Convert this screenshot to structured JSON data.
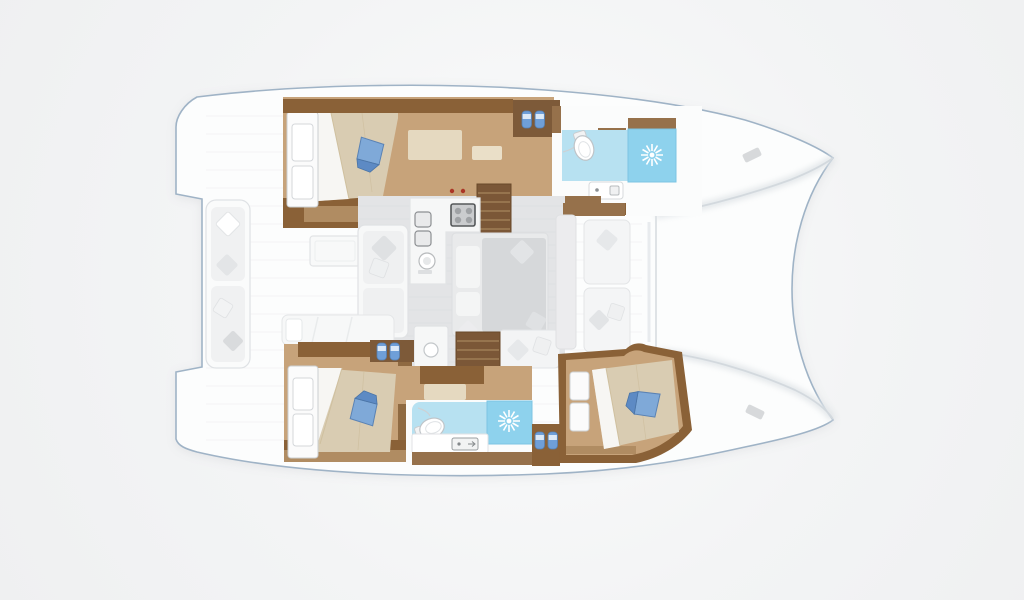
{
  "scene": {
    "subject": "catamaran-interior-floorplan",
    "view": "top-down",
    "orientation": "bow-right"
  },
  "colors": {
    "background": "#f0f1f2",
    "hull_fill": "#fcfdfd",
    "hull_outline": "#9fb3c6",
    "deck_line": "#eceef0",
    "saloon_floor": "#e3e4e6",
    "saloon_line": "#dcdee0",
    "wood_floor": "#c7a37a",
    "wood_dark": "#8a6137",
    "wood_medium": "#96714b",
    "wood_light": "#b08c62",
    "stairs": "#7b5737",
    "step_line": "#a07e57",
    "rug": "#e5d9c0",
    "rug_small": "#eadfc8",
    "mattress": "#d9ccb2",
    "mattress_fold": "#f7f6f3",
    "headboard": "#fbfbfb",
    "pillow_blue": "#7fa9d8",
    "pillow_blue_dark": "#5d8ac4",
    "slipper_blue": "#6f9fd8",
    "slipper_band": "#dce9f7",
    "bath_floor": "#b7e1f1",
    "shower_blue": "#8ed2ed",
    "sunburst": "#ffffff",
    "cushion_light": "#f0f1f2",
    "cushion_gray": "#d9dbdd",
    "counter_white": "#f6f7f7",
    "toilet": "#ffffff",
    "knob_red": "#ab3526"
  },
  "icons": [
    {
      "name": "shower-sunburst-icon"
    },
    {
      "name": "slippers-icon"
    },
    {
      "name": "blue-pillow-icon"
    },
    {
      "name": "cushion-pillow-icon"
    },
    {
      "name": "toilet-icon"
    },
    {
      "name": "stove-icon"
    },
    {
      "name": "sink-icon"
    },
    {
      "name": "stairs-icon"
    },
    {
      "name": "cleat-icon"
    }
  ],
  "rooms": [
    {
      "id": "aft-cockpit"
    },
    {
      "id": "port-aft-cabin"
    },
    {
      "id": "forward-cabin-area"
    },
    {
      "id": "port-forward-bathroom"
    },
    {
      "id": "saloon-galley"
    },
    {
      "id": "starboard-hull-corridor"
    },
    {
      "id": "starboard-aft-cabin"
    },
    {
      "id": "starboard-bathroom"
    },
    {
      "id": "starboard-forward-cabin"
    },
    {
      "id": "foredeck"
    }
  ]
}
